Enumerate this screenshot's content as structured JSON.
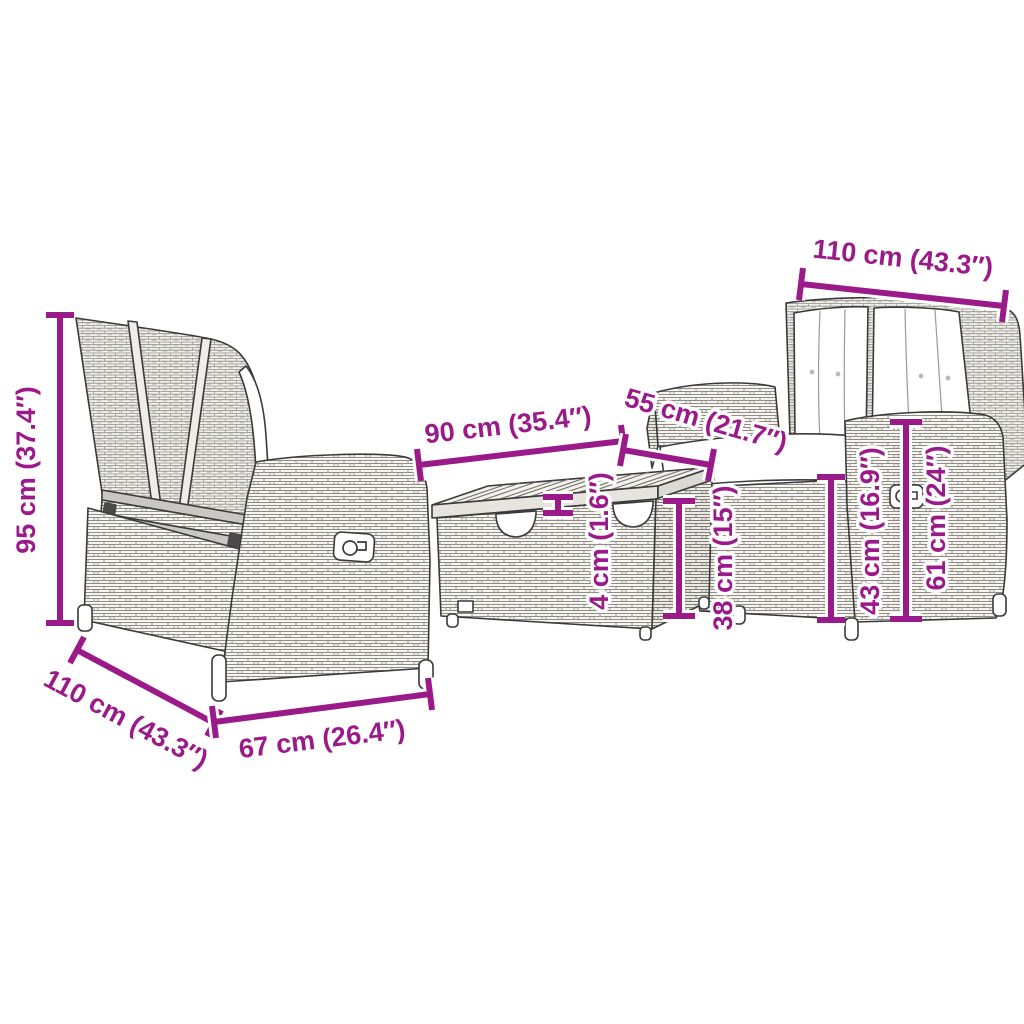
{
  "diagram": {
    "kind": "product-dimension-diagram",
    "product": "3-piece poly rattan garden lounge set (two reclining benches and storage table)",
    "background_color": "#ffffff",
    "accent_color": "#9B1A8A",
    "pieces": {
      "left_bench": "reclining bench shown from rear-left",
      "table": "storage table with wooden slat top",
      "right_bench": "reclining bench with white cushions shown from front-left"
    }
  },
  "dims": {
    "bench_height": {
      "text": "95 cm (37.4″)",
      "measure": "left bench total height"
    },
    "bench_depth": {
      "text": "110 cm (43.3″)",
      "measure": "left bench depth"
    },
    "bench_seat_width": {
      "text": "67 cm (26.4″)",
      "measure": "left bench side width"
    },
    "table_length": {
      "text": "90 cm (35.4″)",
      "measure": "table length"
    },
    "table_depth": {
      "text": "55 cm (21.7″)",
      "measure": "table depth"
    },
    "bench_width": {
      "text": "110 cm (43.3″)",
      "measure": "right bench width"
    },
    "tabletop_thickness": {
      "text": "4 cm (1.6″)",
      "measure": "tabletop thickness"
    },
    "table_height": {
      "text": "38 cm (15″)",
      "measure": "table height"
    },
    "armrest_height": {
      "text": "43 cm (16.9″)",
      "measure": "armrest height"
    },
    "backrest_height": {
      "text": "61 cm (24″)",
      "measure": "side panel height"
    }
  }
}
